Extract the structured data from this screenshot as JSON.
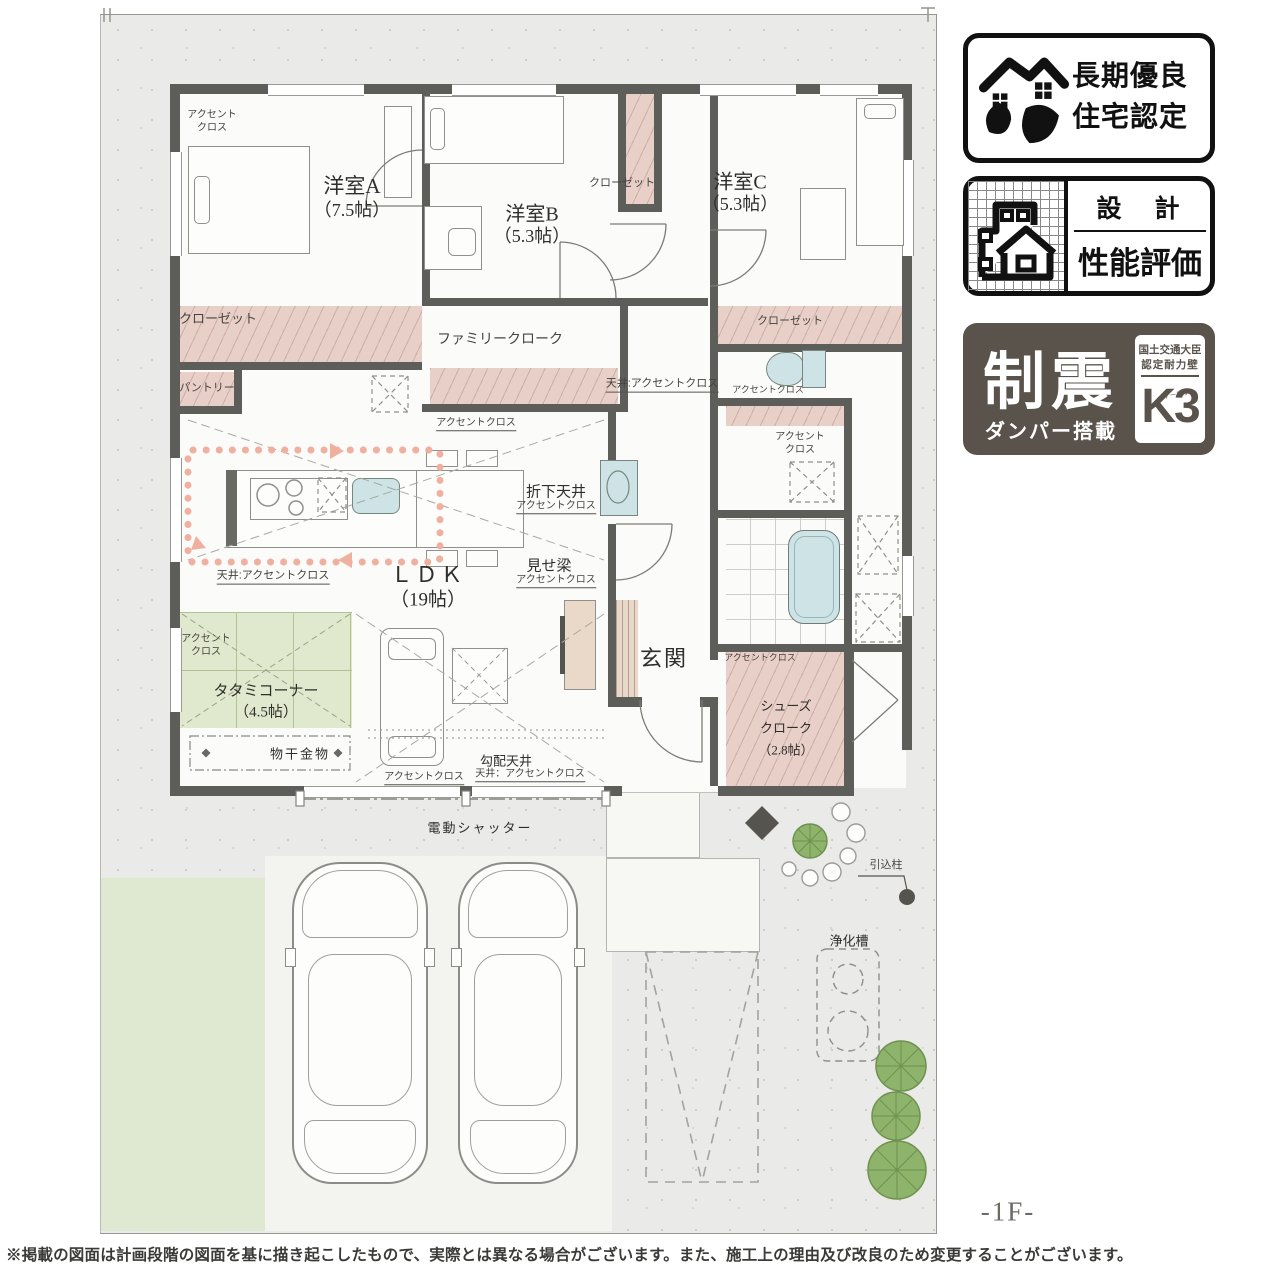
{
  "rooms": {
    "bedroom_a": {
      "name": "洋室A",
      "size": "（7.5帖）"
    },
    "bedroom_b": {
      "name": "洋室B",
      "size": "（5.3帖）"
    },
    "bedroom_c": {
      "name": "洋室C",
      "size": "（5.3帖）"
    },
    "ldk": {
      "name": "ＬＤＫ",
      "size": "（19帖）"
    },
    "tatami_corner": {
      "name": "タタミコーナー",
      "size": "（4.5帖）"
    },
    "shoes_cloak": {
      "name_line1": "シューズ",
      "name_line2": "クローク",
      "size": "（2.8帖）"
    },
    "entrance": {
      "name": "玄関"
    },
    "family_cloak": {
      "name": "ファミリークローク"
    },
    "pantry": {
      "name": "パントリー"
    },
    "closet": {
      "name": "クローゼット"
    }
  },
  "finish_notes": {
    "accent_cloth": "アクセントクロス",
    "accent_cloth_line1": "アクセント",
    "accent_cloth_line2": "クロス",
    "ceiling_accent": "天井:アクセントクロス",
    "ceiling_accent_wide": "天井：アクセントクロス",
    "dropped_ceiling": "折下天井",
    "exposed_beam": "見せ梁",
    "sloped_ceiling": "勾配天井",
    "laundry_hardware": "物干金物"
  },
  "site": {
    "floor_label": "-1F-",
    "shutter": "電動シャッター",
    "pole": "引込柱",
    "septic": "浄化槽"
  },
  "badges": {
    "long_term": {
      "line1": "長期優良",
      "line2": "住宅認定"
    },
    "design_eval": {
      "title": "設　計",
      "subtitle": "性能評価"
    },
    "damper": {
      "main": "制震",
      "sub": "ダンパー搭載",
      "right_line1": "国土交通大臣",
      "right_line2": "認定耐力壁",
      "mark": "K3",
      "mark_kana": "ケースリー"
    }
  },
  "footer": {
    "disclaimer": "※掲載の図面は計画段階の図面を基に描き起こしたもので、実際とは異なる場合がございます。また、施工上の理由及び改良のため変更することがございます。"
  }
}
